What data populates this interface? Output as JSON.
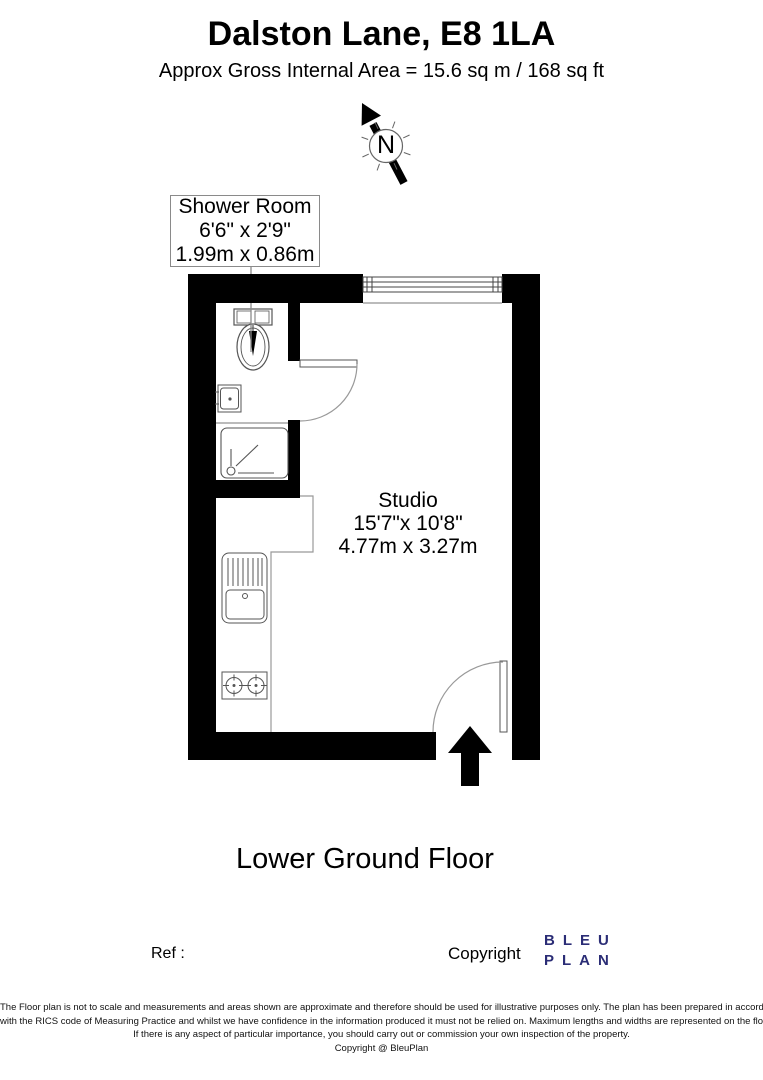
{
  "header": {
    "title": "Dalston Lane, E8 1LA",
    "subtitle": "Approx Gross Internal Area = 15.6 sq m / 168 sq ft"
  },
  "compass": {
    "label": "N"
  },
  "rooms": {
    "shower": {
      "name": "Shower Room",
      "dims_imperial": "6'6\" x 2'9\"",
      "dims_metric": "1.99m x 0.86m"
    },
    "studio": {
      "name": "Studio",
      "dims_imperial": "15'7\"x 10'8\"",
      "dims_metric": "4.77m x 3.27m"
    }
  },
  "plan": {
    "floor_label": "Lower Ground Floor",
    "fixtures": [
      "toilet",
      "wash-basin",
      "shower-tray",
      "shower-screen",
      "kitchen-sink-drainer",
      "hob",
      "kitchen-counter",
      "window",
      "shower-door",
      "entrance-door",
      "entrance-arrow"
    ],
    "wall_color": "#000000",
    "fixture_line_color": "#555555"
  },
  "footer": {
    "ref_label": "Ref  :",
    "copyright_label": "Copyright",
    "logo_line1": "BLEU",
    "logo_line2": "PLAN",
    "logo_color": "#2b2d76"
  },
  "disclaimer": {
    "lines": [
      "The Floor plan is not to scale and measurements and areas shown are approximate and therefore should be used for illustrative purposes only. The plan has been prepared in accordance",
      "with the RICS code of Measuring Practice and whilst we have confidence in the information produced it must not be relied on. Maximum lengths and widths are represented on the floor plan.",
      "If there is any aspect of particular importance, you should carry out or commission your own inspection of the property.",
      "Copyright @ BleuPlan"
    ]
  }
}
